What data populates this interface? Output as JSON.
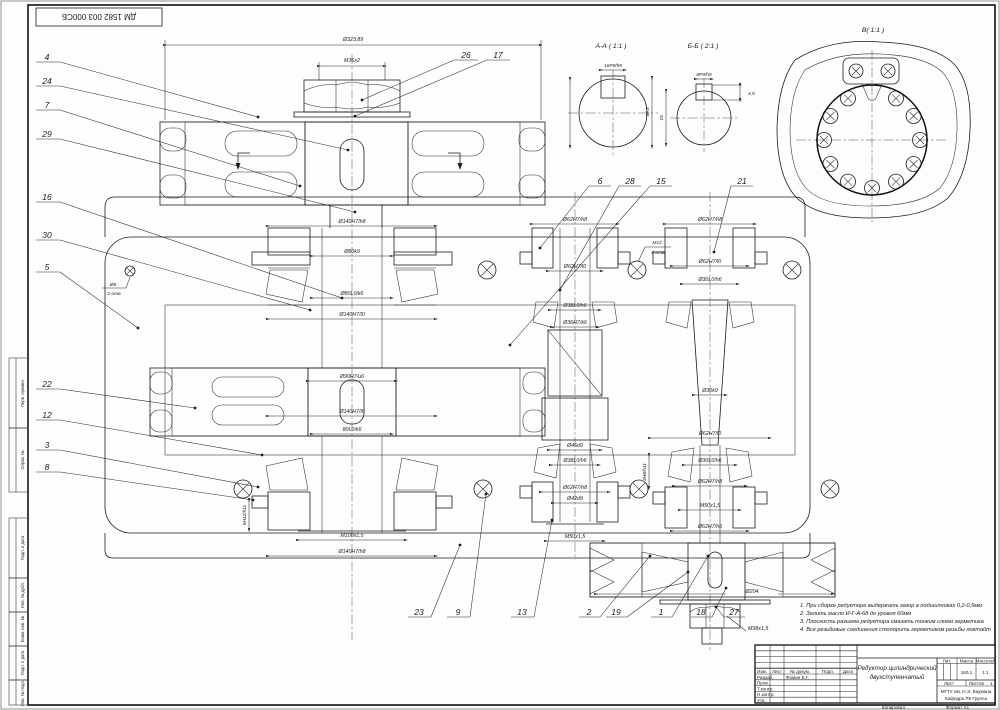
{
  "sheet": {
    "stamp_top_left": "ДМ 1582 003 000СБ",
    "copied_label": "Копировал",
    "format_label": "Формат А1"
  },
  "frame_labels": {
    "c1": "Перв. примен.",
    "c2": "Справ. №",
    "c3": "Подп. и дата",
    "c4": "Инв. № дубл.",
    "c5": "Взам. инв. №",
    "c6": "Подп. и дата",
    "c7": "Инв. № подл."
  },
  "views": {
    "aa_title": "А-А ( 1:1 )",
    "bb_title": "Б-Б ( 2:1 )",
    "v_title": "В( 1:1 )"
  },
  "section_aa": {
    "key": "16P9/h9",
    "depth": "38,3"
  },
  "section_bb": {
    "key": "8P9/h9",
    "height": "15",
    "depth": "4,9"
  },
  "dims": {
    "top_dia": "Ø323,89",
    "nut": "M36x2",
    "l1": "Ø140H7/h8",
    "l2": "Ø80k9",
    "l3": "Ø80L0/k6",
    "l4": "Ø140H7/l0",
    "l5": "Ø90H7/u6",
    "l6": "Ø140H7/l0",
    "l7": "80L0/k6",
    "l8": "M100x1,5",
    "l9": "Ø140H7/h8",
    "lv": "5H12/h11",
    "m1": "Ø62H7/h8",
    "m2": "Ø62H7/l0",
    "m3": "Ø38L0/h6",
    "m3b": "Ø36H7/k6",
    "m4": "Ø46d9",
    "m5": "Ø38L0/h6",
    "m6": "Ø62H7/h8",
    "m7": "Ø42d9",
    "m8": "M50x1,5",
    "mv": "4H8/h11",
    "r1": "Ø62H7/h8",
    "r2": "Ø62H7/l0",
    "r3": "Ø30L0/h6",
    "r4": "Ø30k9",
    "r5": "Ø62H7/l0",
    "r6": "Ø30L0/h6",
    "r7": "Ø62H7/h8",
    "r8": "M50x1,5",
    "r9": "Ø62H7/h6",
    "r10": "Ø204",
    "r11": "M38x1,5",
    "pin": "Ø8",
    "pin2": "2 отв",
    "bolt": "М12",
    "bolt2": "8 отв"
  },
  "positions": {
    "p1": "1",
    "p2": "2",
    "p3": "3",
    "p4": "4",
    "p5": "5",
    "p6": "6",
    "p7": "7",
    "p8": "8",
    "p9": "9",
    "p12": "12",
    "p13": "13",
    "p15": "15",
    "p16": "16",
    "p17": "17",
    "p18": "18",
    "p19": "19",
    "p21": "21",
    "p22": "22",
    "p23": "23",
    "p24": "24",
    "p26": "26",
    "p27": "27",
    "p28": "28",
    "p29": "29",
    "p30": "30"
  },
  "tech_req": [
    "1.   При сборке редуктора выдержать зазор в подшипниках 0,2-0,5мм",
    "2.   Залить масло И-Г-А-68 до уровня 60мм",
    "3.   Плоскость разъема редуктора смазать тонким слоем герметика",
    "4.   Все резьбовые соединения стопорить герметиком резьбы локтайт"
  ],
  "title_block": {
    "izm": "Изм.",
    "list": "Лист",
    "doc": "№ докум.",
    "podp": "Подп.",
    "data": "Дата",
    "razrab": "Разраб.",
    "razrab_name": "Фомин Е.Г.",
    "prov": "Пров.",
    "tkontr": "Т.контр.",
    "nkontr": "Н.контр.",
    "utv": "Утв.",
    "name_line1": "Редуктор цилиндрический",
    "name_line2": "двухступенчатый",
    "lit_label": "Лит.",
    "mass_label": "Масса",
    "scale_label": "Масштаб",
    "mass": "160,1",
    "scale": "1:1",
    "sheet_label": "Лист",
    "sheets_label": "Листов",
    "sheets_value": "1",
    "org_line1": "МГТУ им. Н.Э. Баумана",
    "org_line2": "Кафедра РК  Группа"
  }
}
